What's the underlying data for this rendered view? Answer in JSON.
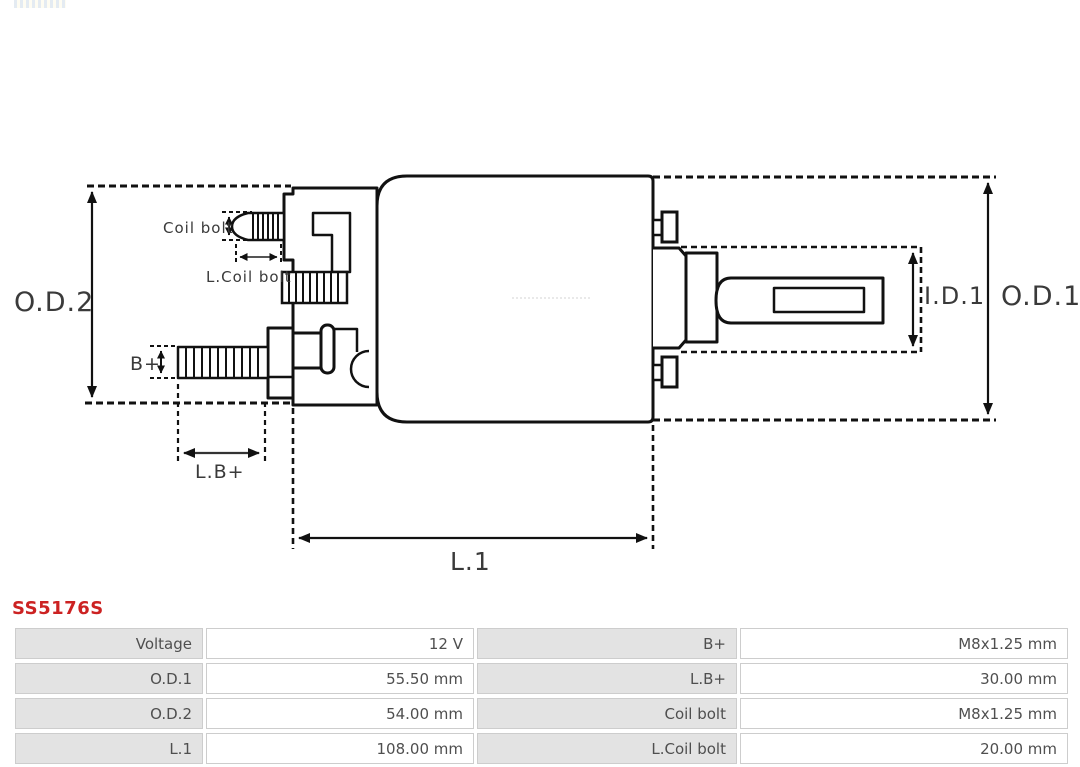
{
  "part": {
    "number": "SS5176S",
    "number_color": "#cc2222"
  },
  "diagram": {
    "type": "starter-solenoid-technical-drawing",
    "stroke_color": "#111111",
    "labels": {
      "od2": "O.D.2",
      "od1": "O.D.1",
      "id1": "I.D.1",
      "l1": "L.1",
      "lb_plus": "L.B+",
      "b_plus": "B+",
      "coil_bolt": "Coil bolt",
      "l_coil_bolt": "L.Coil bolt"
    }
  },
  "spec_table": {
    "label_bg": "#e3e3e3",
    "border_color": "#cdcdcd",
    "text_color": "#4f4f4f",
    "rows": [
      {
        "label1": "Voltage",
        "value1": "12 V",
        "label2": "B+",
        "value2": "M8x1.25 mm"
      },
      {
        "label1": "O.D.1",
        "value1": "55.50 mm",
        "label2": "L.B+",
        "value2": "30.00 mm"
      },
      {
        "label1": "O.D.2",
        "value1": "54.00 mm",
        "label2": "Coil bolt",
        "value2": "M8x1.25 mm"
      },
      {
        "label1": "L.1",
        "value1": "108.00 mm",
        "label2": "L.Coil bolt",
        "value2": "20.00 mm"
      }
    ]
  }
}
